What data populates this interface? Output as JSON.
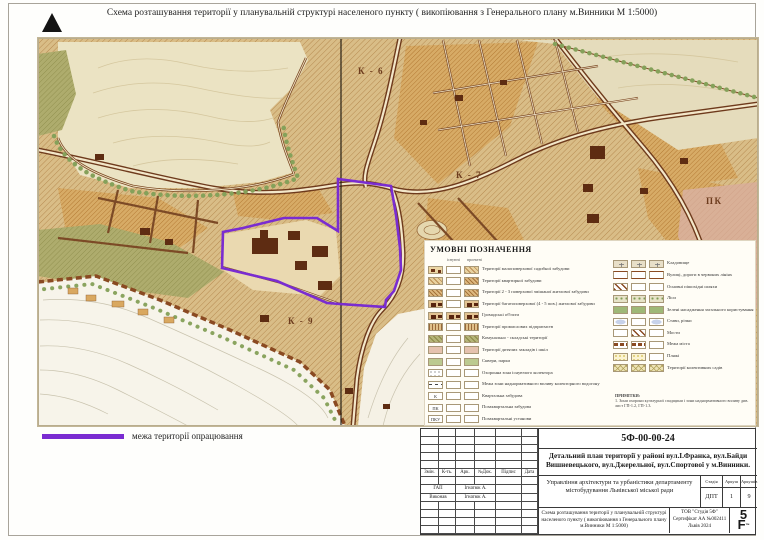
{
  "page": {
    "top_title": "Схема розташування території у планувальній структурі населеного пункту ( викопіювання з Генерального плану м.Винники М 1:5000)"
  },
  "map": {
    "boundary_legend": {
      "label": "межа території опрацювання",
      "color": "#7a2cd1"
    },
    "labels": [
      {
        "text": "К - 6",
        "x": 320,
        "y": 28
      },
      {
        "text": "К - 7",
        "x": 418,
        "y": 132
      },
      {
        "text": "К - 9",
        "x": 250,
        "y": 278
      },
      {
        "text": "ПК",
        "x": 668,
        "y": 158
      }
    ]
  },
  "legend": {
    "title": "УМОВНІ ПОЗНАЧЕННЯ",
    "col_headers": [
      "існуючі",
      "проектні"
    ],
    "left_rows": [
      {
        "label": "Території малоповерхової садибної забудови",
        "sw": [
          "bld",
          "wh",
          "hatch"
        ]
      },
      {
        "label": "Території квартирної забудови",
        "sw": [
          "hatch",
          "wh",
          "hatchd"
        ]
      },
      {
        "label": "Території 2 - 3 поверхової змішаної житлової забудови",
        "sw": [
          "hatchd",
          "wh",
          "hatchd"
        ]
      },
      {
        "label": "Території багатоповерхової (4 - 5 пов.) житлової забудови",
        "sw": [
          "bld2",
          "wh",
          "bld2"
        ]
      },
      {
        "label": "Громадські об'єкти",
        "sw": [
          "bld2",
          "bld2",
          "bld2"
        ]
      },
      {
        "label": "Території промислових підприємств",
        "sw": [
          "hatchv",
          "wh",
          "hatchv"
        ]
      },
      {
        "label": "Комунально - складські території",
        "sw": [
          "olv",
          "wh",
          "olv"
        ]
      },
      {
        "label": "Території дитячих закладів і шкіл",
        "sw": [
          "pkc",
          "wh",
          "pkc"
        ]
      },
      {
        "label": "Сквери, парки",
        "sw": [
          "grn",
          "wh",
          "grn"
        ]
      },
      {
        "label": "Охоронна зона існуючого колектора",
        "sw": [
          "dots",
          "wh",
          "wh"
        ]
      },
      {
        "label": "Межа зони наднормативного впливу колекторного водогону",
        "sw": [
          "dash",
          "wh",
          "wh"
        ]
      },
      {
        "label": "Квартальна забудова",
        "sw": [
          "L:К",
          "wh",
          "wh"
        ]
      },
      {
        "label": "Позаквартальна забудова",
        "sw": [
          "L:ПК",
          "wh",
          "wh"
        ]
      },
      {
        "label": "Позаквартальні установи",
        "sw": [
          "L:ПКУ",
          "wh",
          "wh"
        ]
      }
    ],
    "right_rows": [
      {
        "label": "Кладовище",
        "sw": [
          "cem",
          "cem",
          "cem"
        ]
      },
      {
        "label": "Вулиці, дороги в червоних лініях",
        "sw": [
          "road",
          "road",
          "road"
        ]
      },
      {
        "label": "Основні пішохідні шляхи",
        "sw": [
          "ped",
          "wh",
          "wh"
        ]
      },
      {
        "label": "Ліси",
        "sw": [
          "forest",
          "forest",
          "forest"
        ]
      },
      {
        "label": "Зелені насадження загального користування",
        "sw": [
          "grn2",
          "grn2",
          "grn2"
        ]
      },
      {
        "label": "Стави, річки",
        "sw": [
          "pond",
          "wh",
          "pond"
        ]
      },
      {
        "label": "Мости",
        "sw": [
          "wh",
          "ped",
          "wh"
        ]
      },
      {
        "label": "Межа міста",
        "sw": [
          "border-sw",
          "border-sw",
          "wh"
        ]
      },
      {
        "label": "Пляжі",
        "sw": [
          "beach",
          "beach",
          "wh"
        ]
      },
      {
        "label": "Території колективних садів",
        "sw": [
          "gard",
          "gard",
          "gard"
        ]
      }
    ],
    "notes_title": "ПРИМІТКИ:",
    "notes": "1. Зони охорони культурної спадщини і зони наднормативного впливу див. лист ГП-1.2, ГП-1.3."
  },
  "area_legend": {
    "label": "межа території опрацювання"
  },
  "title_block": {
    "doc_number": "5Ф-00-00-24",
    "project_title": "Детальний план території у районі вул.І.Франка, вул.Байди Вишневецького, вул.Джерельної, вул.Спортової у м.Винники.",
    "client": "Управління архітектури та урбаністики департаменту містобудування Львівської міської ради",
    "stage_label": "Стадія",
    "sheet_label": "Аркуш",
    "sheets_label": "Аркушів",
    "stage": "ДПТ",
    "sheet": "1",
    "sheets": "9",
    "sheet_title": "Схема розташування території у планувальній структурі населеного пункту ( викопіювання з Генерального плану м.Винники М 1:5000)",
    "company": "ТОВ \"Студія 5Ф\"",
    "certificate": "Сертифікат АА №002411",
    "city_year": "Львів 2024",
    "logo_top": "5",
    "logo_bottom": "F",
    "logo_tm": "тм",
    "columns": [
      "Змін.",
      "К-ть.",
      "Арк.",
      "№Док.",
      "Підпис",
      "Дата"
    ],
    "signature_rows": [
      {
        "role": "ГАП",
        "name": "Ігнатюк А."
      },
      {
        "role": "Виконав",
        "name": "Ігнатюк А."
      }
    ]
  }
}
